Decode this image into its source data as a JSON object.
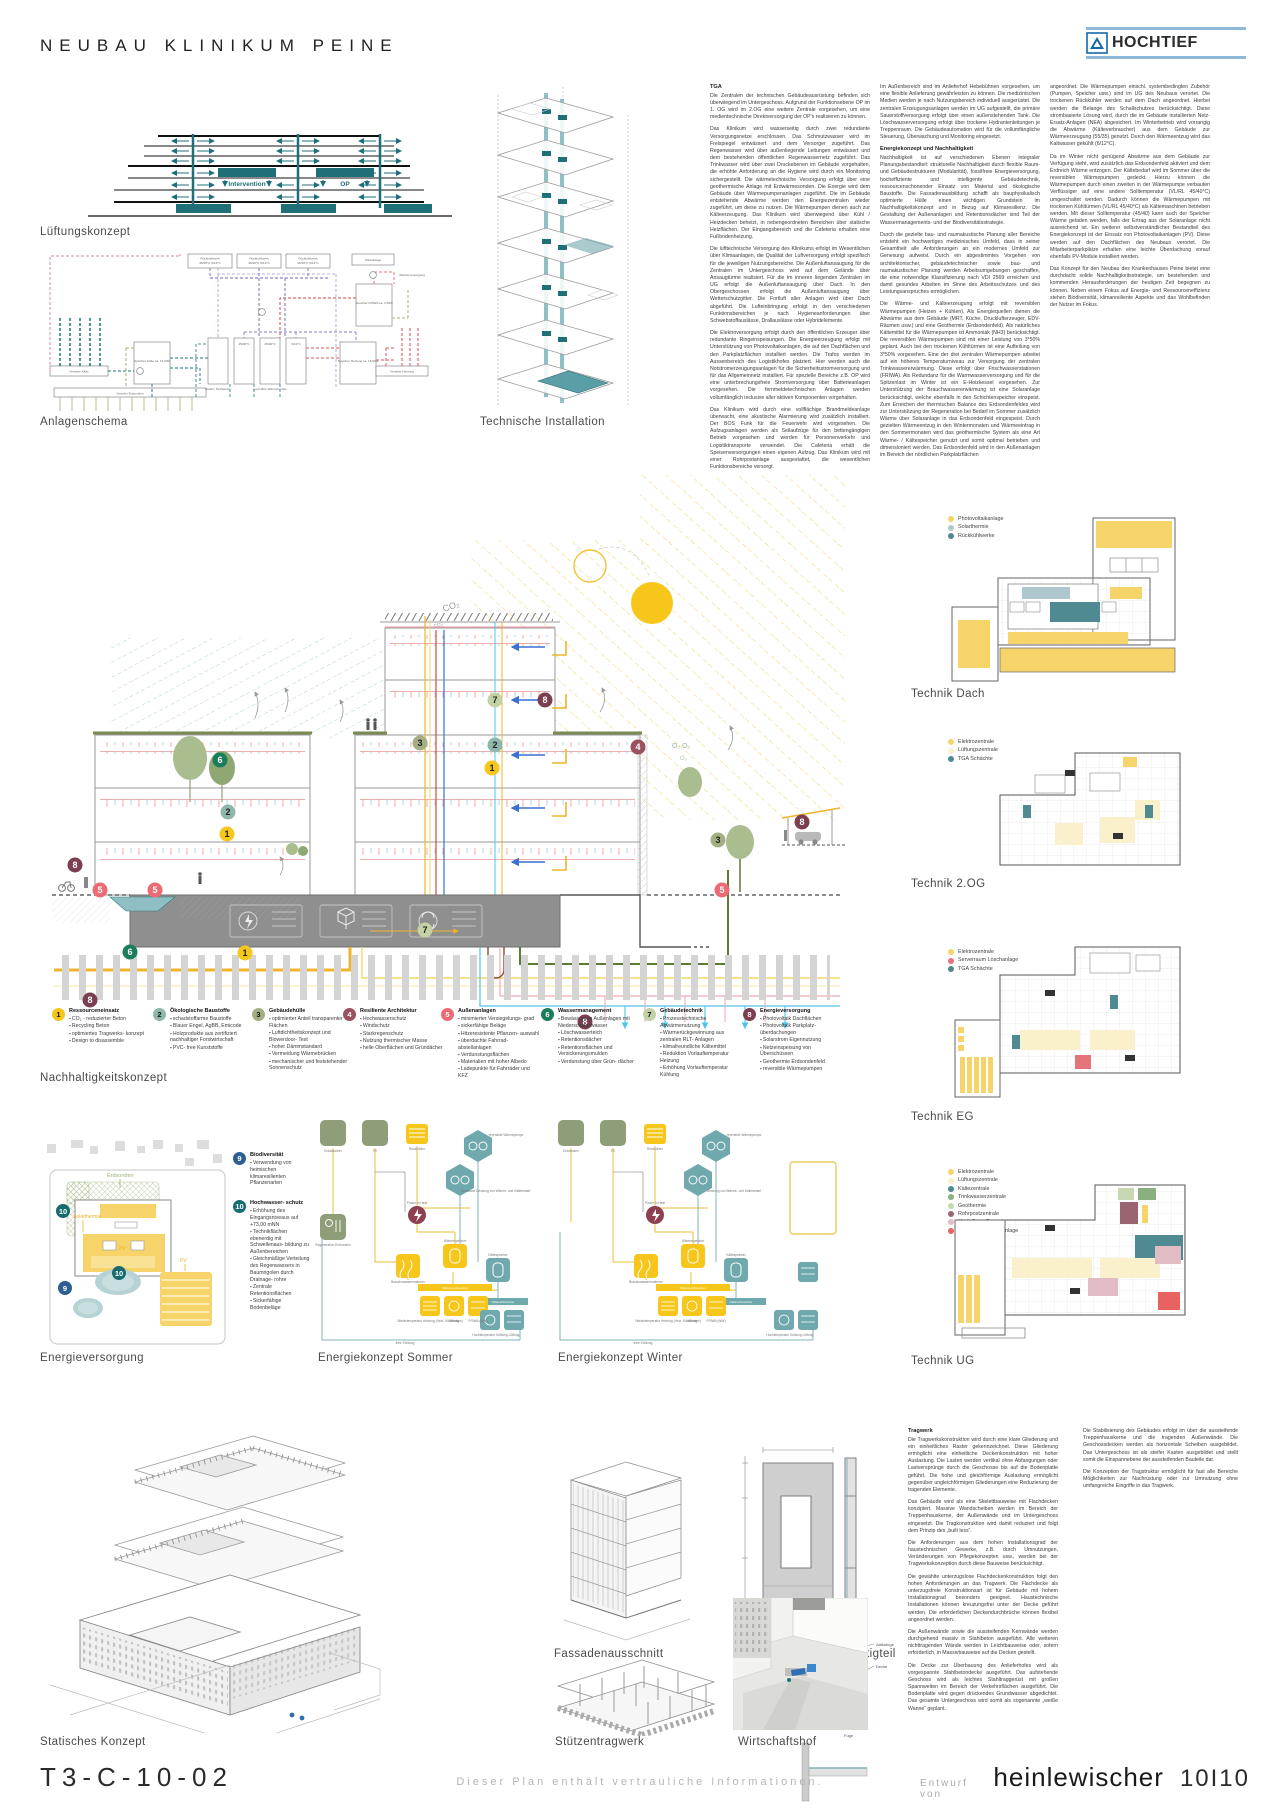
{
  "header": {
    "title": "NEUBAU KLINIKUM PEINE",
    "logo": "HOCHTIEF"
  },
  "captions": {
    "lueftung": "Lüftungskonzept",
    "anlagenschema": "Anlagenschema",
    "technische_installation": "Technische Installation",
    "nachhaltigkeit": "Nachhaltigkeitskonzept",
    "energieversorgung": "Energieversorgung",
    "sommer": "Energiekonzept Sommer",
    "winter": "Energiekonzept Winter",
    "dach": "Technik Dach",
    "og2": "Technik 2.OG",
    "eg": "Technik EG",
    "ug": "Technik UG",
    "statik": "Statisches Konzept",
    "fassade": "Fassadenausschnitt",
    "fertigteil": "Ansicht und Schnitt Fertigteil",
    "stuetzen": "Stützentragwerk",
    "hof": "Wirtschaftshof"
  },
  "tga": {
    "heading": "TGA",
    "col1": [
      "Die Zentralen der technischen Gebäudeausrüstung befinden sich überwiegend im Untergeschoss. Aufgrund der Funktionsebene OP im 1. OG wird im 2.OG eine weitere Zentrale vorgesehen, um eine medientechnische Direktversorgung der OP's realisieren zu können.",
      "Das Klinikum wird wasserseitig durch zwei redundante Versorgungsnetze erschlossen. Das Schmutzwasser wird im Freispiegel entwässert und dem Versorger zugeführt. Das Regenwasser wird über außenliegende Leitungen entwässert und dem bestehenden öffentlichen Regenwassernetz zugeführt. Das Trinkwasser wird über zwei Druckebenen im Gebäude vorgehalten, die erhöhte Anforderung an die Hygiene wird durch ein Monitoring sichergestellt. Die wärmetechnische Versorgung erfolgt über eine geothermische Anlage mit Erdwärmesonden. Die Energie wird dem Gebäude über Wärmepumpenanlagen zugeführt. Die im Gebäude entstehende Abwärme werden den Energiezentralen wieder zugeführt, um diese zu nutzen. Die Wärmepumpen dienen auch zur Kälteerzeugung. Das Klinikum wird überwiegend über Kühl / Heizdecken beheizt, in nebengeordneten Bereichen über statische Heizflächen. Der Eingangsbereich und die Cafeteria erhalten eine Fußbodenheizung.",
      "Die lufttechnische Versorgung des Klinikums erfolgt im Wesentlichen über Klimaanlagen, die Qualität der Luftversorgung erfolgt spezifisch für die jeweiligen Nutzungsbereiche. Die Außenluftansaugung für die Zentralen im Untergeschoss wird auf dem Gelände über Ansaugtürme realisiert. Für die im inneren liegenden Zentralen im UG erfolgt die Außenluftansaugung über Dach. In den Obergeschossen erfolgt die Außenluftansaugung über Wetterschutzgitter. Die Fortluft aller Anlagen wird über Dach abgeführt. Die Lufteinbringung erfolgt in den verschiedenen Funktionsbereichen je nach Hygieneanforderungen über Schwebstoffauslässe, Drallauslässe oder Hybridelemente.",
      "Die Elektroversorgung erfolgt durch den öffentlichen Erzeuger über redundante Ringeinspeisungen. Die Energieerzeugung erfolgt mit Unterstützung von Photovoltaikanlagen, die auf den Dachflächen und den Parkplatzflächen installiert werden. Die Trafos werden im Aussenbereich des Logistikhofes platziert. Hier werden auch die Notstromerzeugungsanlagen für die Sicherheitsstromversorgung und für das Allgemeinnetz installiert. Für spezielle Bereiche z.B. OP wird eine unterbrechungsfreie Stromversorgung über Batterieanlagen vorgesehen. Die fernmeldetechnischen Anlagen werden vollumfänglich inclusive aller aktiven Komponenten vorgehalten.",
      "Das Klinikum wird durch eine vollflächige Brandmeldeanlage überwacht, eine akustische Alarmierung wird zusätzlich installiert. Der BOS Funk für die Feuerwehr wird vorgesehen. Die Aufzugsanlagen werden als Seilaufzüge für den bettengängigen Betrieb vorgesehen und werden für Personenverkehr und Logistiktransporte verwendet. Die Cafeteria erhält die Speisenversorgungen einen eigenen Aufzug. Das Klinikum wird mit einer Rohrpostanlage ausgestattet, die wesentlichen Funktionsbereiche versorgt."
    ],
    "col2_intro": "Im Außenbereich sind im Anlieferhof Hebebühnen vorgesehen, um eine flexible Anlieferung gewährleisten zu können. Die medizinischen Medien werden je nach Nutzungsbereich individuell ausgerüstet. Die zentralen Erzeugungsanlagen werden im UG aufgestellt, die primäre Sauerstoffversorgung erfolgt über einen außenstehenden Tank. Die Löschwasserversorgung erfolgt über trockene Hydrantenleitungen je Treppenraum. Die Gebäudeautomation wird für die vollumfängliche Steuerung, Überwachung und Monitoring eingesetzt.",
    "heading2": "Energiekonzept und Nachhaltigkeit",
    "col2": [
      "Nachhaltigkeit ist auf verschiedenen Ebenen integraler Planungsbestandteil: strukturelle Nachhaltigkeit durch flexible Raum- und Gebäudestrukturen (Modularität), fossilfreie Energieversorgung, hocheffiziente und intelligente Gebäudetechnik, ressourcenschonender Einsatz von Material und ökologische Baustoffe. Die Fassadenausbildung schafft als bauphysikalisch optimierte Hülle einen wichtigen Grundstein im Nachhaltigkeitskonzept und in Bezug auf Klimaresilienz. Die Gestaltung der Außenanlagen und Retentionsdächer sind Teil der Wassermanagements- und der Biodiversitätsstrategie.",
      "Durch die gezielte bau- und raumakustische Planung aller Bereiche entsteht ein hochwertiges medizinisches Umfeld, dass in seiner Gesamtheit alle Anforderungen an ein modernes Umfeld zur Genesung aufweist. Durch ein abgestimmtes Vorgehen von architektonischer, gebäudetechnischer sowie bau- und raumakustischer Planung werden Arbeitsumgebungen geschaffen, die eine notwendige Klassifizierung nach VDI 2569 erreichen und damit gesundes Arbeiten im Sinne des Arbeitsschutzes und des Leistungsanspruches ermöglichen.",
      "Die Wärme- und Kälteerzeugung erfolgt mit reversiblen Wärmepumpen (Heizen + Kühlen). Als Energiequellen dienen die Abwärme aus dem Gebäude (MRT, Küche, Drucklufterzeuger, EDV-Räumen usw.) und eine Geothermie (Erdsondenfeld). Als natürliches Kältemittel für die Wärmepumpen ist Ammoniak (NH3) berücksichtigt. Die reversiblen Wärmepumpen sind mit einer Leistung von 3*50% geplant. Auch bei den trockenen Kühltürmen ist eine Aufteilung von 3*50% vorgesehen. Eine der drei zentralen Wärmepumpen arbeitet auf ein höheres Temperaturniveau zur Versorgung der zentralen Trinkwassererwärmung. Diese erfolgt über Frischwasserstationen (FRIWA). Als Redundanz für die Warmwasserversorgung und für die Spitzenlast im Winter ist ein E-Heizkessel vorgesehen. Zur Unterstützung der Brauchwassererwärmung ist eine Solaranlage berücksichtigt, welche ebenfalls in den Schichtenspeicher einspeist. Zum Erreichen der thermischen Balance des Erdsondenfeldes wird zur Unterstützung der Regeneration bei Bedarf im Sommer zusätzlich Wärme über Solaranlage in das Erdsondenfeld eingespeist. Durch gezielten Wärmeentzug in den Wintermonaten und Wärmeeintrag in den Sommermonaten wird das geothermische System als eine Art Wärme- / Kältespeicher genutzt und somit optimal betrieben und dimensioniert werden. Das Erdsondenfeld wird in den Außenanlagen im Bereich der nördlichen Parkplatzflächen"
    ],
    "col3": [
      "angeordnet. Die Wärmepumpen einschl. systembedingten Zubehör (Pumpen, Speicher usw.) sind im UG des Neubaus verortet. Die trockenen Rückkühler werden auf dem Dach angeordnet. Hierbei werden die Belange des Schallschutzes berücksichtigt. Diese strombasierte Lösung wird, durch die im Gebäude installierten Netz-Ersatz-Anlagen (NEA) abgesichert. Im Winterbetrieb wird vorrangig die Abwärme (Kälteverbraucher) aus dem Gebäude zur Wärmeerzeugung (55/35) genutzt. Durch den Wärmeentzug wird das Kaltwasser gekühlt (6/12°C).",
      "Da im Winter nicht genügend Abwärme aus dem Gebäude zur Verfügung steht, wird zusätzlich das Erdsondenfeld aktiviert und dem Erdreich Wärme entzogen. Der Kältebedarf wird im Sommer über die reversiblen Wärmepumpen gedeckt. Hierzu können die Wärmepumpen durch einen zweiten in der Wärmepumpe verbauten Verflüssiger auf eine andere Solltemperatur (VL/RL 45/40°C) umgeschaltet werden. Dadurch können die Wärmepumpen mit trockenen Kühltürmen (VL/RL 45/40°C) als Kältemaschinen betrieben werden. Mit dieser Solltemperatur (45/40) kann auch der Speicher Wärme geladen werden, falls der Ertrag aus der Solaranlage nicht ausreichend ist. Ein weiterer selbstverständlicher Bestandteil des Energiekonzept ist der Einsatz von Photovoltaikanlagen (PV). Diese werden auf den Dachflächen des Neubaus verortet. Die Mitarbeiterparkplätze erhalten eine leichte Überdachung vorauf ebenfalls PV-Module installiert werden.",
      "Das Konzept für den Neubau des Krankenhauses Peine bietet eine durchdacht solide Nachhaltigkeitsstrategie, um bestehenden und kommenden Herausforderungen der heutigen Zeit begegnen zu können. Neben einem Fokus auf Energie- und Ressourceneffizienz stehen Biodiversität, klimaresiliente Aspekte und das Wohlbefinden der Nutzer im Fokus."
    ]
  },
  "lueftung_labels": {
    "intervention": "Intervention",
    "op": "OP"
  },
  "anlagenschema_labels": {
    "rueck": "Rückkühlwerk",
    "rueck_t": "45/40°C 6/12°C",
    "solar": "Solaranlage",
    "wasser": "Wasserversorgung",
    "friwa": "Speicher FRIWA ca. 2.500l",
    "sp_kaelte": "Speicher Kälte ca. 15.000l",
    "vt_kaelte": "Verteiler Kälte",
    "vt_erdsonden": "Verteiler Erdsonden",
    "heizkessel": "Elektro Heizkessel",
    "wp": "reversible Wärmepumpe",
    "wp_t1": "45/40°C",
    "wp_t2": "6/12°C",
    "sp_heizung": "Speicher Heizung ca. 15.000l",
    "vt_heizung": "Verteiler Heizung"
  },
  "section_labels": {
    "co2": "CO₂",
    "co2b": "co₂",
    "o2": "O₂ O₂",
    "o2b": "O₂"
  },
  "legend": {
    "items": [
      {
        "num": "1",
        "color": "#F6C61A",
        "title": "Ressourceneinsatz",
        "bullets": [
          "CO₂ - reduzierter Beton",
          "Recycling Beton",
          "optimiertes Tragwerks- konzept",
          "Design to disassemble"
        ]
      },
      {
        "num": "2",
        "color": "#8FB7AC",
        "title": "Ökologische Baustoffe",
        "bullets": [
          "schadstoffarme Baustoffe",
          "Blauer Engel, AgBB, Emicode",
          "Holzprodukte aus zertifiziert nachhaltiger Forstwirtschaft",
          "PVC- free Kunststoffe"
        ]
      },
      {
        "num": "3",
        "color": "#A3AF83",
        "title": "Gebäudehülle",
        "bullets": [
          "optimierter Anteil transparenter Flächen",
          "Luftdichtheitskonzept und Blowerdoor- Test",
          "hoher Dämmstandard",
          "Vermeidung Wärmebrücken",
          "mechanischer und feststehender Sonnenschutz"
        ]
      },
      {
        "num": "4",
        "color": "#9A5160",
        "title": "Resiliente Architektur",
        "bullets": [
          "Hochwasserschutz",
          "Windschutz",
          "Starkregenschutz",
          "Nutzung thermischer Masse",
          "helle Oberflächen und Gründächer"
        ]
      },
      {
        "num": "5",
        "color": "#ED6A75",
        "title": "Außenanlagen",
        "bullets": [
          "minimierter Versiegelungs- grad",
          "sickerfähige Beläge",
          "Hitzeresistente Pflanzen- auswahl",
          "überdachte Fahrrad- abstellanlagen",
          "Verdunstungsflächen",
          "Materialien mit hoher Albedo",
          "Ladepunkte für Fahrräder und KFZ"
        ]
      },
      {
        "num": "6",
        "color": "#1B7D5B",
        "title": "Wassermanagement",
        "bullets": [
          "Bewässerung Außenlagen mit Niederschlagswasser",
          "Löschwasserteich",
          "Retentionsdächer",
          "Retentionsflächen und Versickerungsmulden",
          "Verdunstung über Grün- dächer"
        ]
      },
      {
        "num": "7",
        "color": "#C3D2A4",
        "title": "Gebäudetechnik",
        "bullets": [
          "Prozesstechnische Abwärmenutzung",
          "Wärmerückgewinnung aus zentralen RLT- Anlagen",
          "klimafreundliche Kältemittel",
          "Reduktion Vorlauftemperatur Heizung",
          "Erhöhung Vorlauftemperatur Kühlung"
        ]
      },
      {
        "num": "8",
        "color": "#7C3F50",
        "title": "Energieversorgung",
        "bullets": [
          "Photovoltaik Dachflächen",
          "Photovoltaik Parkplatz- überdachungen",
          "Solarstrom Eigennutzung",
          "Netzeinspeisung von Überschüssen",
          "Geothermie Erdsondenfeld",
          "reversible Wärmepumpen"
        ]
      }
    ]
  },
  "site_legend": {
    "items": [
      {
        "num": "9",
        "color": "#2F5E91",
        "title": "Biodiversität",
        "bullets": [
          "Verwendung von heimischen klimaresilienten Pflanzenarten"
        ]
      },
      {
        "num": "10",
        "color": "#156B6E",
        "title": "Hochwasser- schutz",
        "bullets": [
          "Erhöhung des Eingangsniveaus auf +73,00 mNN",
          "Technikflächen ebenerdig mit Schwellenaus- bildung zu Außenbereichen",
          "Gleichmäßige Verteilung des Regenwassers in Baumrigolen durch Drainage- rohre",
          "Zentrale Retentionsflächen",
          "Sickerfähige Bodenbeläge"
        ]
      }
    ]
  },
  "site_labels": {
    "erdsonden": "Erdsonden",
    "solarthermie": "Solarthermie",
    "pv1": "PV",
    "pv2": "PV"
  },
  "sommer": {
    "a": "Erdabsorber",
    "b": "PV",
    "c": "Rückkühler",
    "hex1": "reversible Wärmepumpe",
    "hex2": "simultane Deckung von Wärme- und Kältebedarf",
    "p2h": "Power to Heat",
    "regen": "Regeneration Erdsonden",
    "wsp": "Wärmespeicher",
    "bww": "Brauchwassererwärmer",
    "wvb": "Wärmeverbraucher",
    "k1": "Niedertemperatur Heizung (Heiz- Kühldecken)",
    "k2": "Lüftung",
    "k3": "FRIWA (WW)",
    "ksp": "Kältespeicher",
    "kvb": "Kälteverbraucher",
    "n1": "Hochtemperatur Kühlung",
    "n2": "Lüftung",
    "fk": "freie Kühlung"
  },
  "winter": {
    "a": "Erdsonden",
    "b": "PV",
    "c": "Rückkühler",
    "hex1": "reversible Wärmepumpe",
    "hex2": "Deckung von Wärme- und Kältebedarf",
    "p2h": "Power to Heat",
    "regen": "Regeneration Erdsonden",
    "wsp": "Wärmespeicher",
    "bww": "Brauchwassererwärmer",
    "wvb": "Wärmeverbraucher",
    "k1": "Niedertemperatur Heizung (Heiz- Kühldecken)",
    "k2": "Lüftung",
    "k3": "FRIWA (WW)",
    "ksp": "Kältespeicher",
    "kvb": "Kälteverbraucher",
    "n1": "Hochtemperatur Kühlung",
    "n2": "Lüftung",
    "fk": "freie Kühlung"
  },
  "plans": {
    "dach": {
      "legend": [
        {
          "label": "Photovoltaikanlage",
          "color": "#F6D469"
        },
        {
          "label": "Solarthermie",
          "color": "#AFC8CF"
        },
        {
          "label": "Rückkühlwerke",
          "color": "#4F8A93"
        }
      ]
    },
    "og2": {
      "legend": [
        {
          "label": "Elektrozentrale",
          "color": "#F6D469"
        },
        {
          "label": "Lüftungszentrale",
          "color": "#FAF0CB"
        },
        {
          "label": "TGA Schächte",
          "color": "#4F8A93"
        }
      ]
    },
    "eg": {
      "legend": [
        {
          "label": "Elektrozentrale",
          "color": "#F6D469"
        },
        {
          "label": "Serverraum Löschanlage",
          "color": "#E4737A"
        },
        {
          "label": "TGA Schächte",
          "color": "#4F8A93"
        }
      ]
    },
    "ug": {
      "legend": [
        {
          "label": "Elektrozentrale",
          "color": "#F6D469"
        },
        {
          "label": "Lüftungszentrale",
          "color": "#FAF0CB"
        },
        {
          "label": "Kältezentrale",
          "color": "#4F8A93"
        },
        {
          "label": "Trinkwasserzentrale",
          "color": "#8BAF7E"
        },
        {
          "label": "Geothermie",
          "color": "#C8D8B2"
        },
        {
          "label": "Rohrpostzentrale",
          "color": "#9A6570"
        },
        {
          "label": "Med. Gase Zentrale",
          "color": "#E2BCC5"
        },
        {
          "label": "Serverraum Löschanlage",
          "color": "#E8625F"
        }
      ]
    }
  },
  "tragwerk": {
    "heading": "Tragwerk",
    "col1": [
      "Die Tragwerkskonstruktion wird durch eine klare Gliederung und ein einheitliches Raster gekennzeichnet. Diese Gliederung ermöglicht eine einheitliche Deckenkonstruktion mit hoher Auslastung. Die Lasten werden vertikal ohne Abfangungen oder Lastversprünge durch die Geschosse bis auf die Bodenplatte geführt. Die hohe und gleichförmige Auslastung ermöglicht gegenüber ungleichförmigen Gliederungen eine Reduzierung der tragenden Elemente.",
      "Das Gebäude wird als eine Skelettbauweise mit Flachdecken konzipiert. Massive Wandscheiben werden im Bereich der Treppenhauskerne, der Außenwände und im Untergeschoss eingesetzt. Die Tragkonstruktion wird damit reduziert und folgt dem Prinzip des „built less“.",
      "Die Anforderungen aus dem hohen Installationsgrad der haustechnischen Gewerke, z.B. durch Umnutzungen, Veränderungen von Pflegekonzepten usw., werden bei der Tragwerkskonzeption durch diese Bauweise berücksichtigt.",
      "Die gewählte unterzugslose Flachdeckenkonstruktion folgt den hohen Anforderungen an das Tragwerk. Die Flachdecke als unterzugsfreie Konstruktionsart ist für Gebäude mit hohem Installationsgrad besonders geeignet. Haustechnische Installationen können kreuzungsfrei unter der Decke geführt werden. Die erforderlichen Deckendurchbrüche können flexibel angeordnet werden.",
      "Die Außenwände sowie die aussteifenden Kernwände werden durchgehend massiv in Stahlbeton ausgeführt. Alle weiteren nichttragenden Wände werden in Leichtbauweise oder, sofern erforderlich, in Massivbauweise auf die Decken gestellt.",
      "Die Decke zur Überbauung des Anlieferhofes wird als vorgespannte Stahlbetondecke ausgeführt. Das aufstehende Geschoss wird als leichtes Stahltraggerüst mit großen Spannweiten im Bereich der Verkehrsflächen ausgeführt. Die Bodenplatte wird gegen drückendes Grundwasser abgedichtet. Das gesamte Untergeschoss wird somit als sogenannte „weiße Wanne“ geplant."
    ],
    "col2": [
      "Die Stabilisierung des Gebäudes erfolgt im über die aussteifende Treppenhauskerne und die tragenden Außenwände. Die Geschossdecken werden als horizontale Scheiben ausgebildet. Das Untergeschoss ist als steifer Kasten ausgebildet und stellt somit die Einspannebene der aussteifenden Bauteile dar.",
      "Die Konzeption der Tragstruktur ermöglicht für fast alle Bereiche Möglichkeiten zur Nachrüstung oder zur Umnutzung ohne umfangreiche Eingriffe in das Tragwerk."
    ],
    "detail_labels": {
      "d1": "Attikafuge",
      "d2": "Decke",
      "d3": "Fuge"
    }
  },
  "footer": {
    "plan_no": "T3-C-10-02",
    "confidential": "Dieser Plan enthält vertrauliche Informationen.",
    "credit_prefix": "Entwurf von",
    "author": "heinlewischer",
    "pages": "10I10"
  }
}
